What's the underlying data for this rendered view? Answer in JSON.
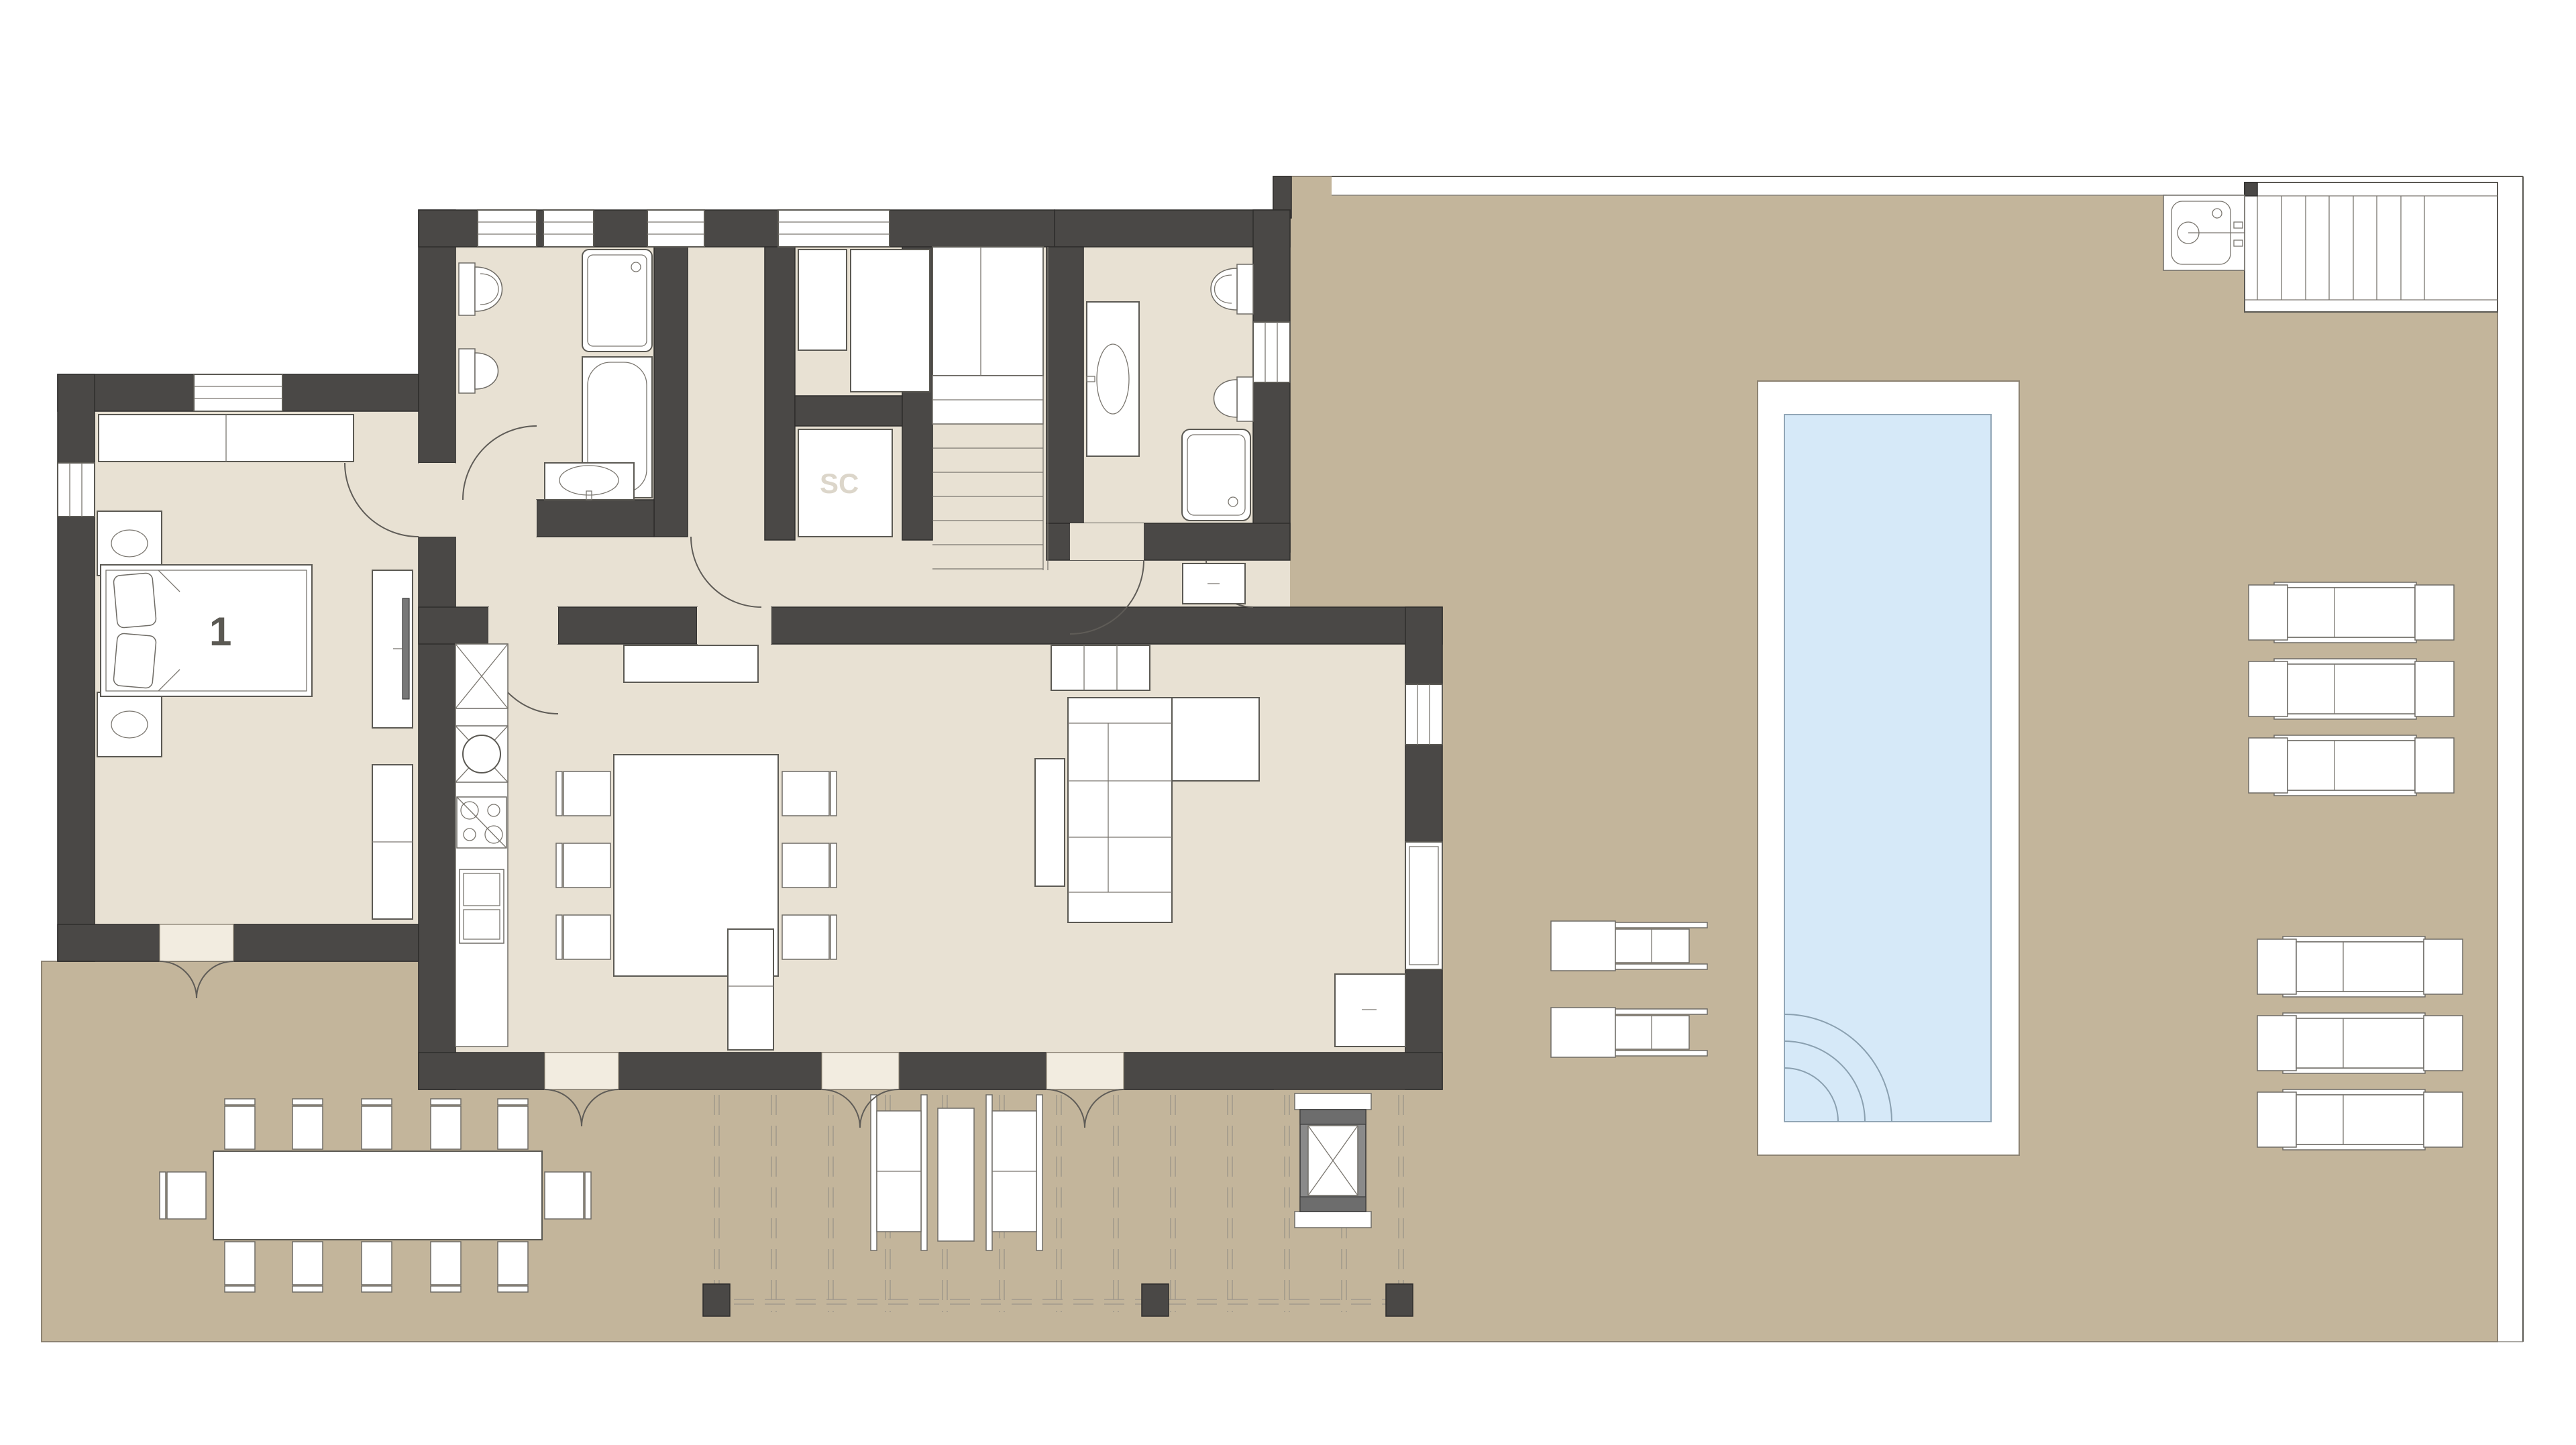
{
  "labels": {
    "bedroom_number": "1",
    "storage_closet": "SC"
  },
  "palette": {
    "background": "#FFFFFF",
    "wall": "#4A4846",
    "interior_floor": "#E8E1D3",
    "terrace": "#C3B59B",
    "pool_water": "#D6E9F8",
    "furniture_fill": "#FFFFFF",
    "outline": "#5B5953"
  },
  "plan": {
    "kind": "villa-ground-floor-plan",
    "features": [
      "bedroom-1",
      "bathroom-1",
      "laundry",
      "storage-closet-SC",
      "staircase",
      "bathroom-2",
      "hall",
      "kitchen-dining",
      "living-room",
      "pergola-terrace",
      "outdoor-dining-table-12-seats",
      "bbq-grill",
      "swimming-pool",
      "sun-loungers",
      "outdoor-sink",
      "exterior-stairs"
    ]
  }
}
